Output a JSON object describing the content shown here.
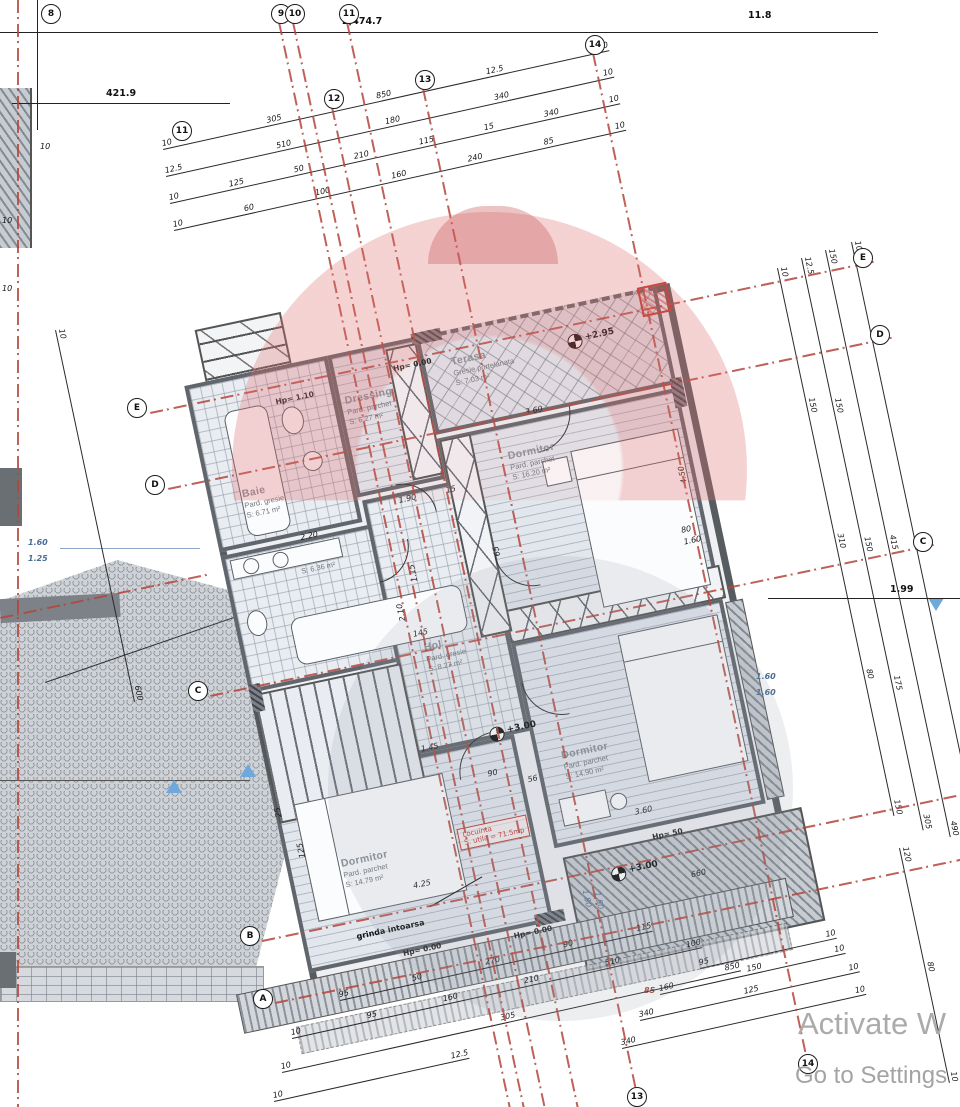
{
  "watermark": {
    "line1": "Activate W",
    "line2": "Go to Settings"
  },
  "axes": {
    "top": [
      "8",
      "9",
      "10",
      "11"
    ],
    "mid": [
      "11",
      "12",
      "13",
      "14"
    ],
    "bottom": [
      "13",
      "14"
    ],
    "left": [
      "E",
      "D",
      "C",
      "B",
      "A"
    ],
    "right": [
      "E",
      "D",
      "C"
    ]
  },
  "dims": {
    "total": "2,474.7",
    "left_total": "421.9",
    "right_total": "11.8",
    "r199": "1.99",
    "edge_ticks": [
      "10",
      "10",
      "10"
    ],
    "top_rows": [
      [
        "10",
        "305",
        "850",
        "12.5",
        "10"
      ],
      [
        "12.5",
        "510",
        "180",
        "340",
        "10"
      ],
      [
        "10",
        "125",
        "50",
        "210",
        "115",
        "15",
        "340",
        "10"
      ],
      [
        "10",
        "60",
        "100",
        "160",
        "240",
        "85",
        "10"
      ]
    ],
    "bottom_left_rows": [
      [
        "95",
        "50",
        "270",
        "90",
        "115"
      ],
      [
        "10",
        "95",
        "160",
        "210",
        "510",
        "100"
      ],
      [
        "10",
        "305",
        "850"
      ],
      [
        "10",
        "12.5"
      ]
    ],
    "bottom_right_rows": [
      [
        "95",
        "10"
      ],
      [
        "160",
        "150",
        "10"
      ],
      [
        "340",
        "125",
        "10"
      ],
      [
        "340",
        "10"
      ]
    ],
    "right_cols": [
      [
        "10",
        "150",
        "310",
        "80",
        "150"
      ],
      [
        "12.5",
        "150",
        "150",
        "175",
        "305"
      ],
      [
        "150",
        "415",
        "490"
      ],
      [
        "10",
        "200",
        "950"
      ],
      [
        "120",
        "80",
        "10"
      ]
    ],
    "left_col": [
      "10",
      "600"
    ],
    "left_pair": [
      "1.60",
      "1.25"
    ],
    "right_pair": [
      "1.60",
      "1.60"
    ],
    "roof_pair": [
      "1.80",
      "1.50"
    ],
    "axis_red": "85",
    "interior": [
      "3.60",
      "4.50",
      "2.20",
      "1.90",
      "1.15",
      "2.10",
      "1.45",
      "90",
      "56",
      "4.25",
      "3.60",
      "660",
      "80",
      "1.60",
      "125",
      "25",
      "65",
      "15",
      "145"
    ]
  },
  "rooms": {
    "terasa": {
      "name": "Terasa",
      "finish": "Gresie portelanata",
      "area": "S: 7.03 m²"
    },
    "dormitor_ne": {
      "name": "Dormitor",
      "finish": "Pard. parchet",
      "area": "S: 16.20 m²"
    },
    "dressing": {
      "name": "Dressing",
      "finish": "Pard. parchet",
      "area": "S: 6.27 m²"
    },
    "baie": {
      "name": "Baie",
      "finish": "Pard. gresie",
      "area": "S: 6.71 m²"
    },
    "baie_mica": {
      "area": "S: 6.36 m²"
    },
    "hol": {
      "name": "Hol",
      "finish": "Pard. gresie",
      "area": "S: 8.27 m²"
    },
    "dormitor_sv": {
      "name": "Dormitor",
      "finish": "Pard. parchet",
      "area": "S: 14.79 m²"
    },
    "dormitor_se": {
      "name": "Dormitor",
      "finish": "Pard. parchet",
      "area": "S: 14.90 m²"
    }
  },
  "levels": {
    "terasa": "+2.95",
    "hol": "+3.00",
    "balcony": "+3.00",
    "hp_baie": "Hp= 1.10",
    "hp_dressing": "Hp= 0.00",
    "hp_sw": "Hp= 0.00",
    "hp_s": "Hp= 0.00",
    "hp_se": "Hp= 50"
  },
  "red_box": {
    "line1": "Locuinta",
    "line2": "S. utila = 71.5mp"
  },
  "notes": {
    "beam": "grinda intoarsa"
  },
  "colors": {
    "axis_red": "#b4453a",
    "wall": "#575c61",
    "pink": "#de6c6c",
    "blue": "#6fa8dc"
  }
}
